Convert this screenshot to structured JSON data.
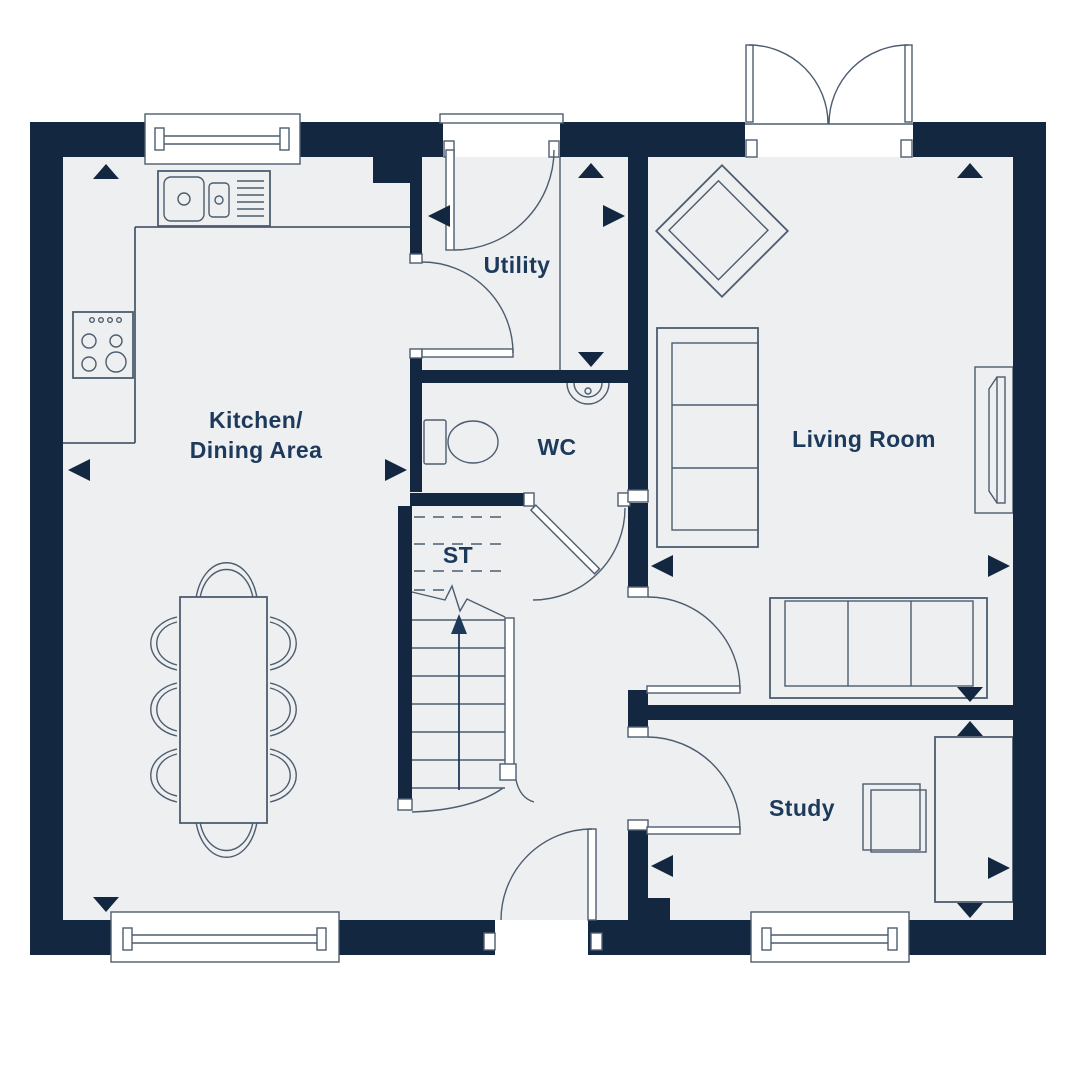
{
  "labels": {
    "kitchen_line1": "Kitchen/",
    "kitchen_line2": "Dining Area",
    "utility": "Utility",
    "wc": "WC",
    "storage": "ST",
    "living_room": "Living Room",
    "study": "Study"
  },
  "colors": {
    "wall": "#132741",
    "floor": "#edeff0",
    "line": "#4d5d6f",
    "text": "#1d3a5c",
    "background": "#ffffff"
  }
}
